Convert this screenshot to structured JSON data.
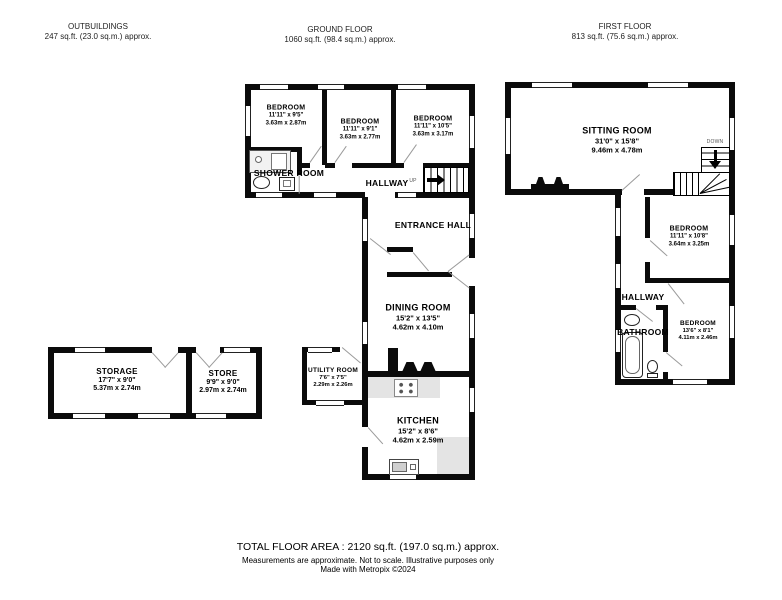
{
  "sections": {
    "outbuildings_header": {
      "title": "OUTBUILDINGS",
      "area": "247 sq.ft. (23.0 sq.m.) approx."
    },
    "ground_floor_header": {
      "title": "GROUND FLOOR",
      "area": "1060 sq.ft. (98.4 sq.m.) approx."
    },
    "first_floor_header": {
      "title": "FIRST FLOOR",
      "area": "813 sq.ft. (75.6 sq.m.) approx."
    }
  },
  "ground_floor": {
    "bedroom_1": {
      "name": "BEDROOM",
      "imperial": "11'11\" x 9'5\"",
      "metric": "3.63m x 2.87m"
    },
    "bedroom_2": {
      "name": "BEDROOM",
      "imperial": "11'11\" x 9'1\"",
      "metric": "3.63m x 2.77m"
    },
    "bedroom_3": {
      "name": "BEDROOM",
      "imperial": "11'11\" x 10'5\"",
      "metric": "3.63m x 3.17m"
    },
    "shower_room": {
      "name": "SHOWER ROOM"
    },
    "hallway": {
      "name": "HALLWAY",
      "stairs_label": "UP"
    },
    "entrance_hall": {
      "name": "ENTRANCE HALL"
    },
    "dining_room": {
      "name": "DINING ROOM",
      "imperial": "15'2\" x 13'5\"",
      "metric": "4.62m x 4.10m"
    },
    "utility_room": {
      "name": "UTILITY ROOM",
      "imperial": "7'6\" x 7'5\"",
      "metric": "2.29m x 2.26m"
    },
    "kitchen": {
      "name": "KITCHEN",
      "imperial": "15'2\" x 8'6\"",
      "metric": "4.62m x 2.59m"
    }
  },
  "outbuildings": {
    "storage": {
      "name": "STORAGE",
      "imperial": "17'7\" x 9'0\"",
      "metric": "5.37m x 2.74m"
    },
    "store": {
      "name": "STORE",
      "imperial": "9'9\" x 9'0\"",
      "metric": "2.97m x 2.74m"
    }
  },
  "first_floor": {
    "sitting_room": {
      "name": "SITTING ROOM",
      "imperial": "31'0\" x 15'8\"",
      "metric": "9.46m x 4.78m"
    },
    "bedroom_1": {
      "name": "BEDROOM",
      "imperial": "11'11\" x 10'8\"",
      "metric": "3.64m x 3.25m"
    },
    "hallway": {
      "name": "HALLWAY"
    },
    "bathroom": {
      "name": "BATHROOM"
    },
    "bedroom_2": {
      "name": "BEDROOM",
      "imperial": "13'6\" x 8'1\"",
      "metric": "4.11m x 2.46m"
    },
    "stairs_label": "DOWN"
  },
  "footer": {
    "total": "TOTAL FLOOR AREA : 2120 sq.ft. (197.0 sq.m.) approx.",
    "disclaimer": "Measurements are approximate.  Not to scale.  Illustrative purposes only",
    "credit": "Made with Metropix ©2024"
  }
}
